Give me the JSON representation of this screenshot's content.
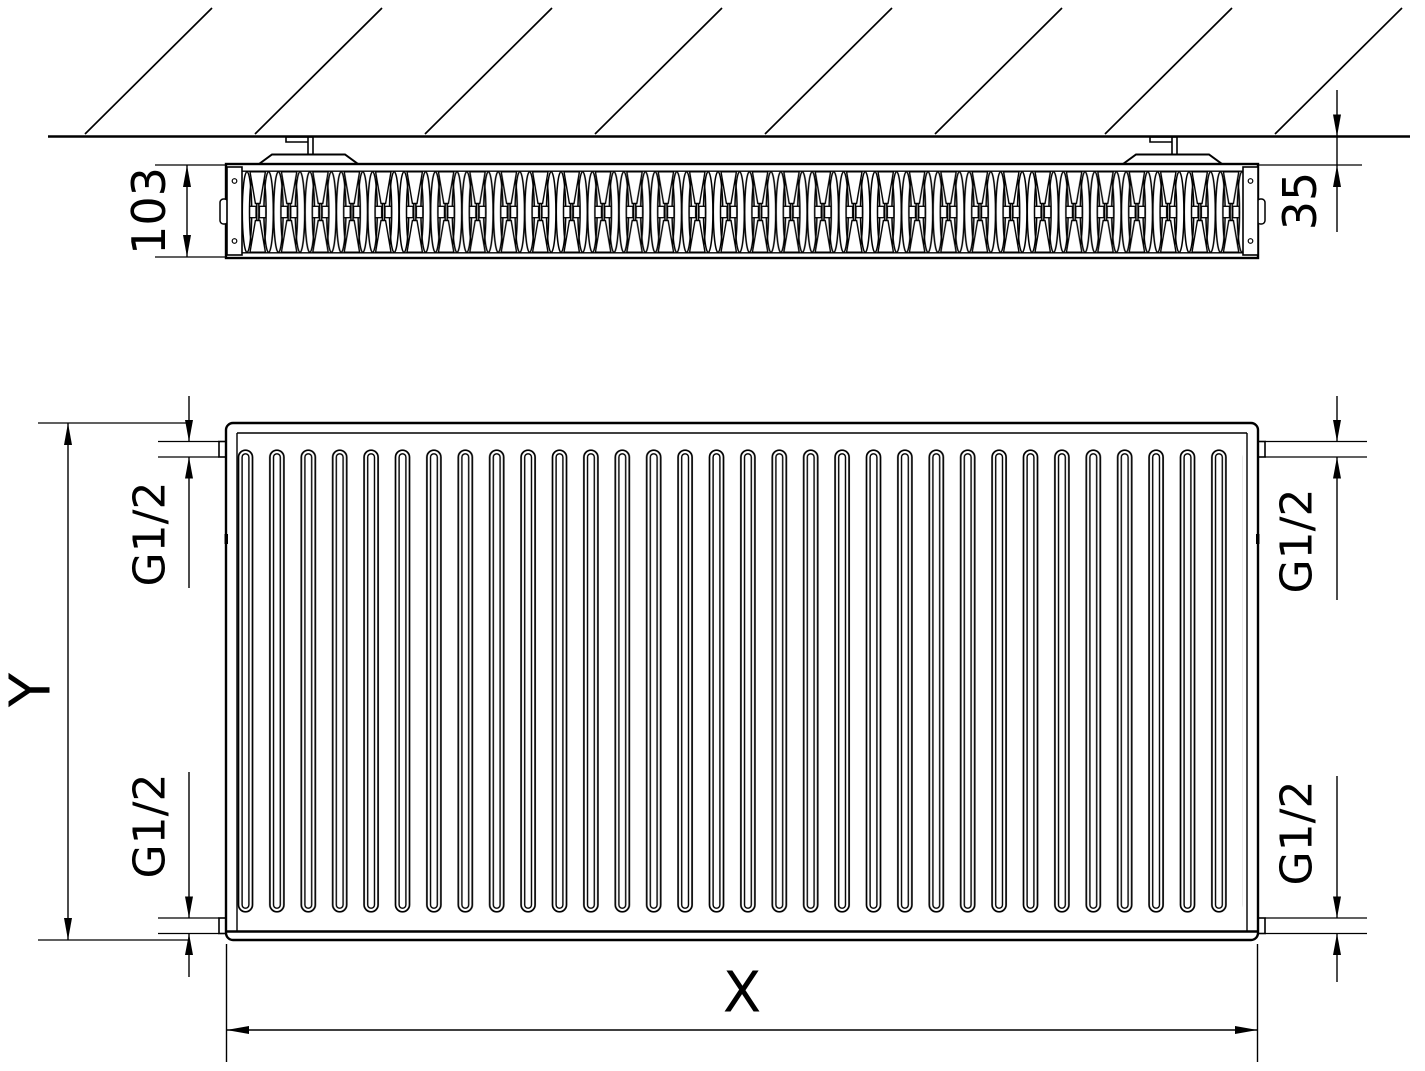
{
  "drawing": {
    "labels": {
      "depth": "103",
      "wall_distance": "35",
      "height": "Y",
      "width": "X",
      "conn_top_left": "G1/2",
      "conn_top_right": "G1/2",
      "conn_bottom_left": "G1/2",
      "conn_bottom_right": "G1/2"
    },
    "style": {
      "line_color": "#000000",
      "background": "#ffffff"
    },
    "counts": {
      "front_channels": 32,
      "wall_hatch_lines": 8,
      "wall_brackets": 2
    }
  }
}
